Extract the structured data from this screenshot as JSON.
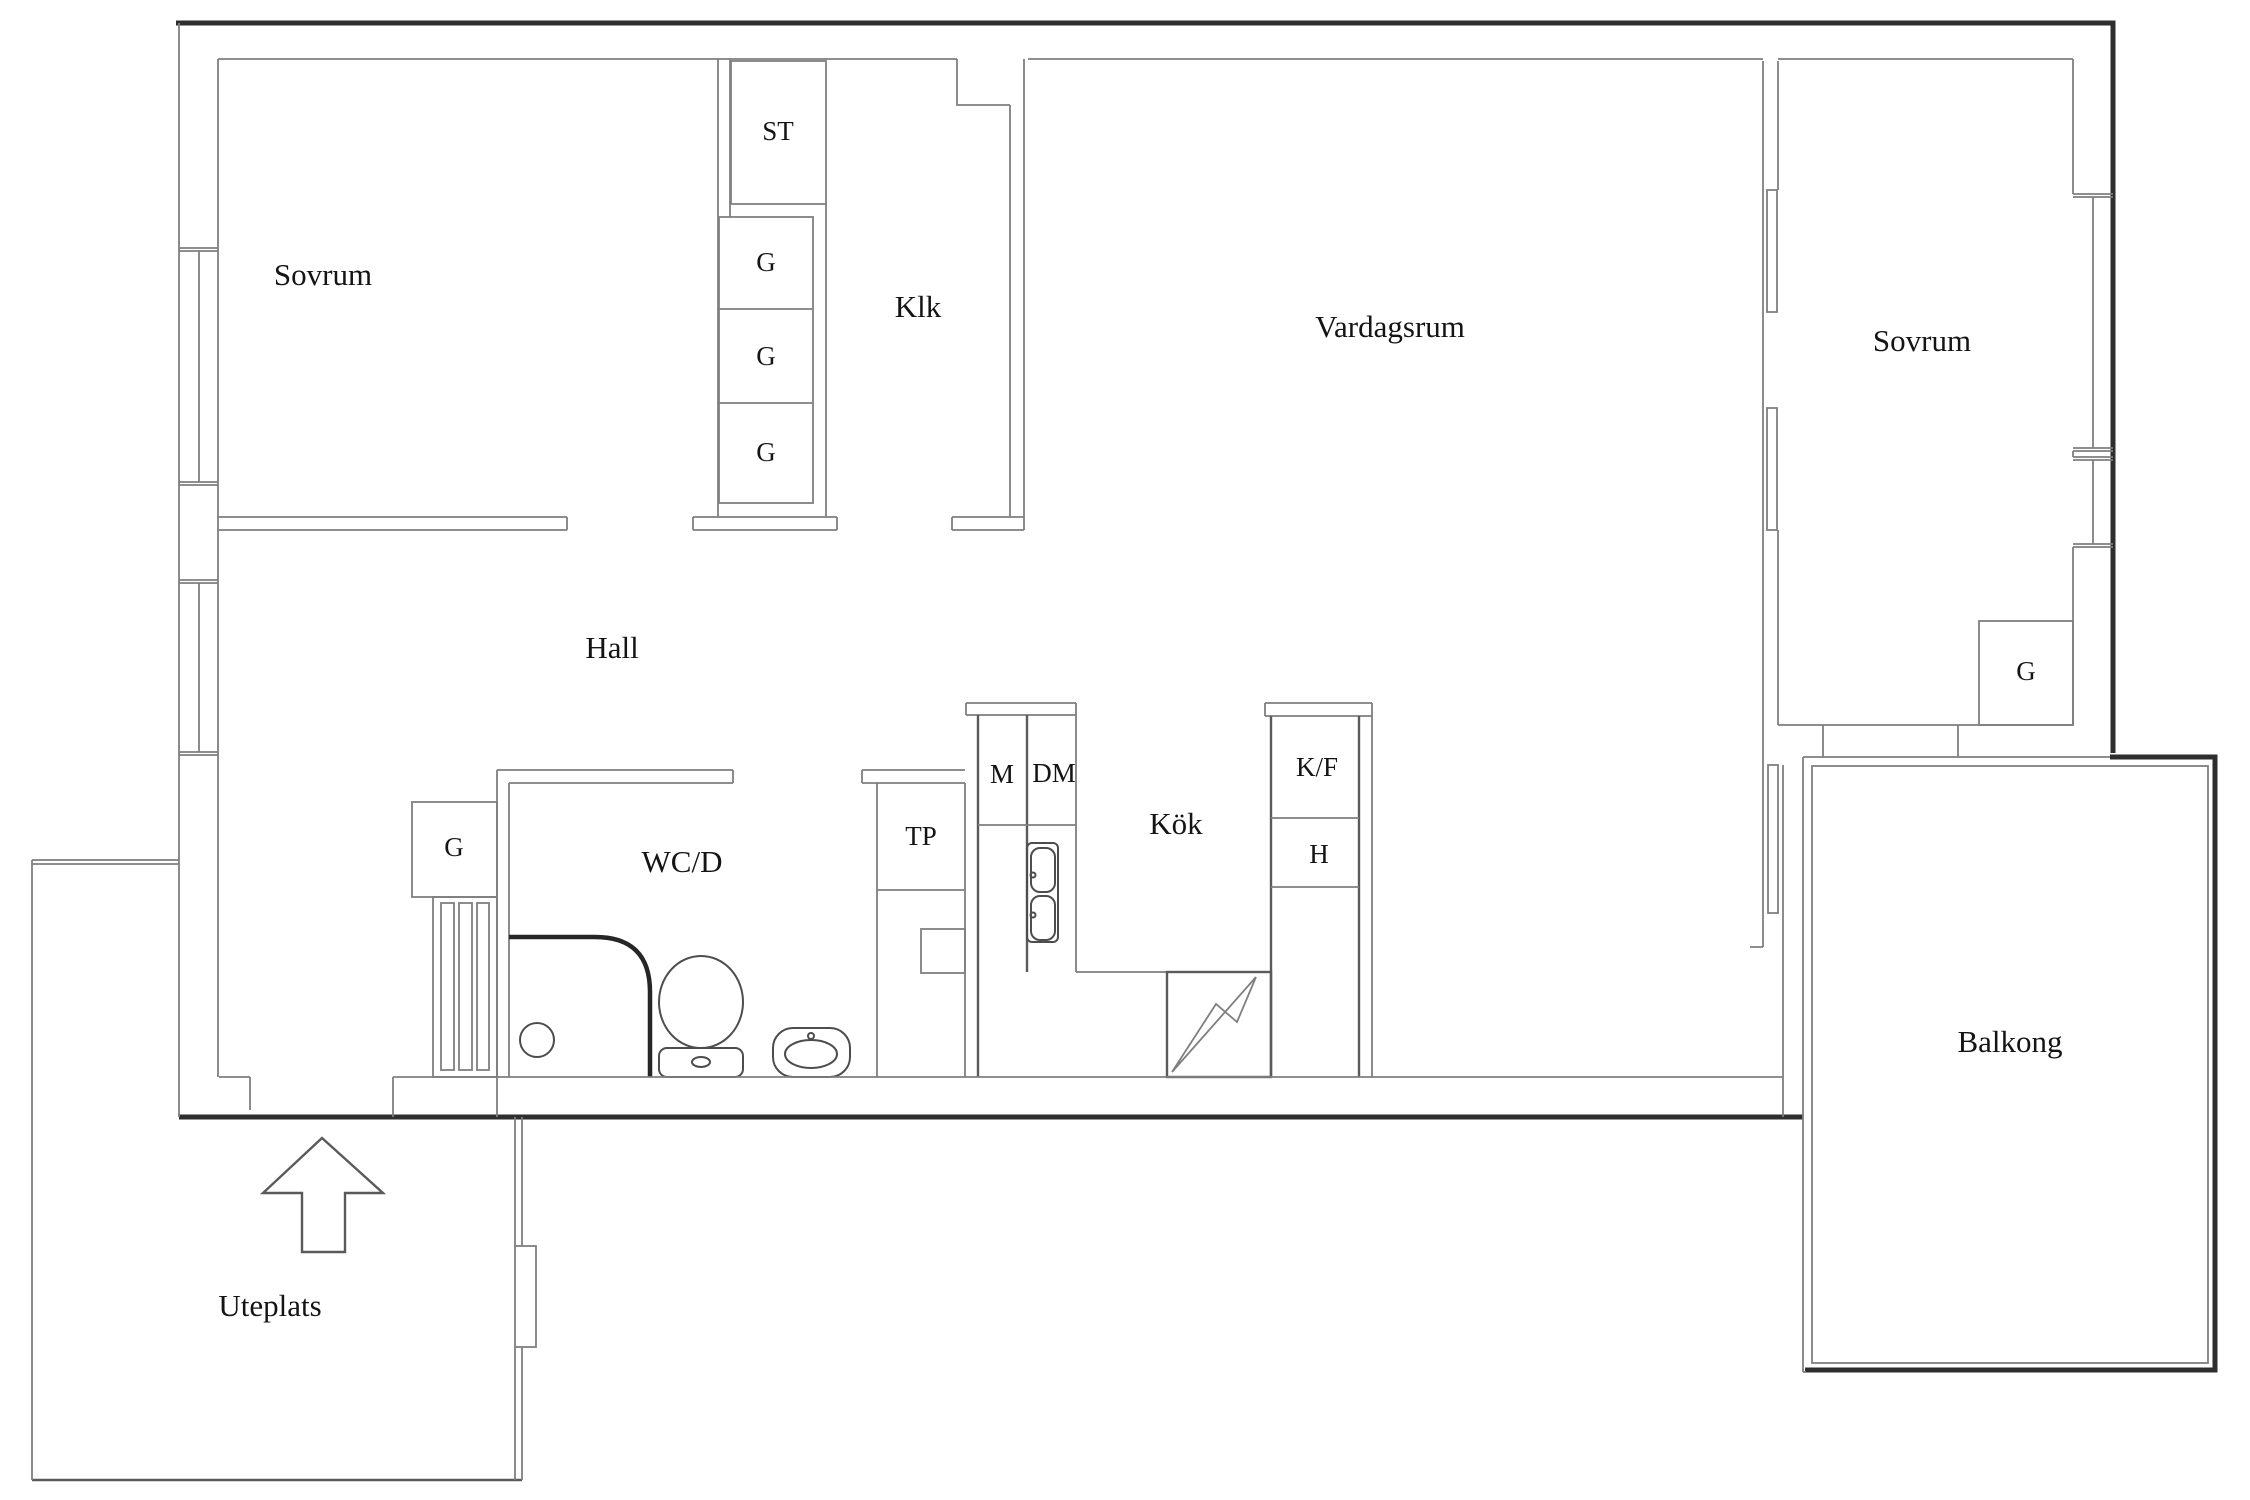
{
  "meta": {
    "type": "floor-plan",
    "language": "Swedish",
    "colors": {
      "background": "#ffffff",
      "wall_thick": "#2e2e2e",
      "wall_thin": "#7f7f7f",
      "fixture": "#4d4d4d",
      "text": "#141414"
    }
  },
  "rooms": {
    "sovrum_left": {
      "label": "Sovrum"
    },
    "klk": {
      "label": "Klk"
    },
    "vardagsrum": {
      "label": "Vardagsrum"
    },
    "sovrum_right": {
      "label": "Sovrum"
    },
    "hall": {
      "label": "Hall"
    },
    "wcd": {
      "label": "WC/D"
    },
    "kok": {
      "label": "Kök"
    },
    "balkong": {
      "label": "Balkong"
    },
    "uteplats": {
      "label": "Uteplats"
    }
  },
  "closets": {
    "st": {
      "label": "ST"
    },
    "g_column_1": {
      "label": "G"
    },
    "g_column_2": {
      "label": "G"
    },
    "g_column_3": {
      "label": "G"
    },
    "g_hall": {
      "label": "G"
    },
    "g_sovrum_right": {
      "label": "G"
    },
    "tp": {
      "label": "TP"
    },
    "m": {
      "label": "M"
    },
    "dm": {
      "label": "DM"
    },
    "kf": {
      "label": "K/F"
    },
    "h": {
      "label": "H"
    }
  }
}
